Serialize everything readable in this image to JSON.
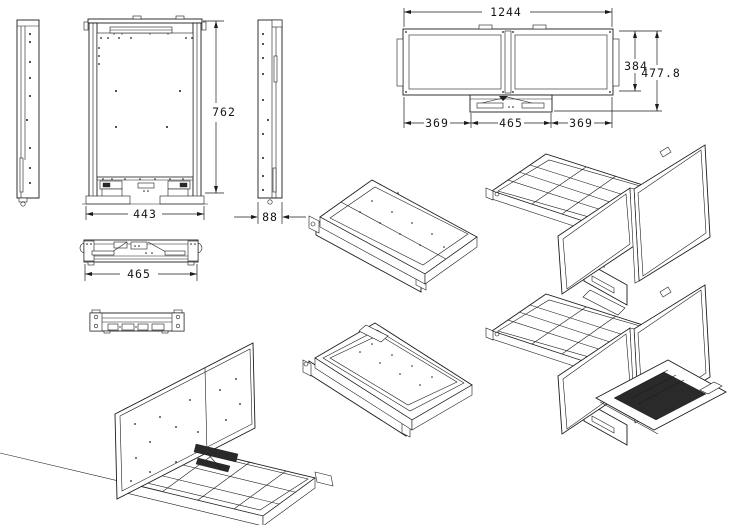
{
  "drawing": {
    "unfolded_view": {
      "total_width": "1244",
      "screen_height": "384",
      "overall_height": "477.8",
      "left_span": "369",
      "base_width": "465",
      "right_span": "369"
    },
    "folded_front_view": {
      "height": "762",
      "width": "443"
    },
    "side_view": {
      "depth": "88"
    },
    "drawer_front_view": {
      "width": "465"
    }
  }
}
